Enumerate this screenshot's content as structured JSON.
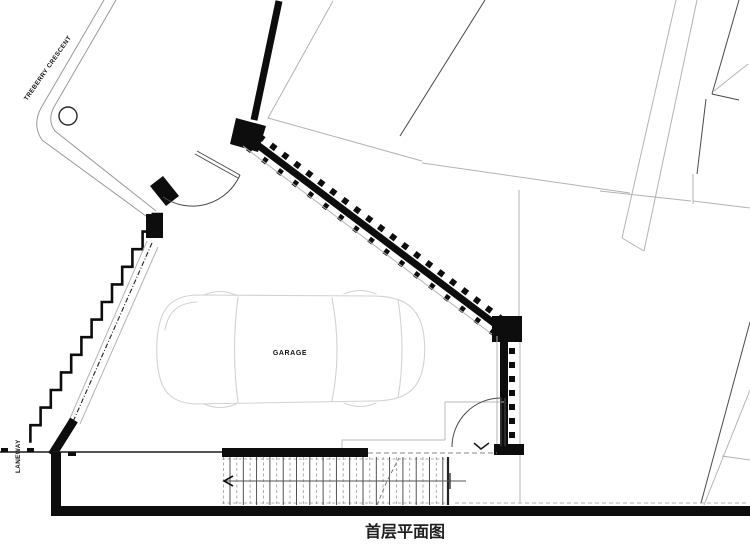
{
  "labels": {
    "street_name": "TREBERRY CRESCENT",
    "laneway": "LANEWAY",
    "room": "GARAGE",
    "plan_title": "首层平面图"
  },
  "colors": {
    "wall": "#0d0d0d",
    "site_line": "#9a9a9a",
    "neighbor_line": "#b3b3b3",
    "neighbor_line_dark": "#4a4a4a",
    "car_line": "#d2d2d2",
    "background": "#ffffff"
  }
}
